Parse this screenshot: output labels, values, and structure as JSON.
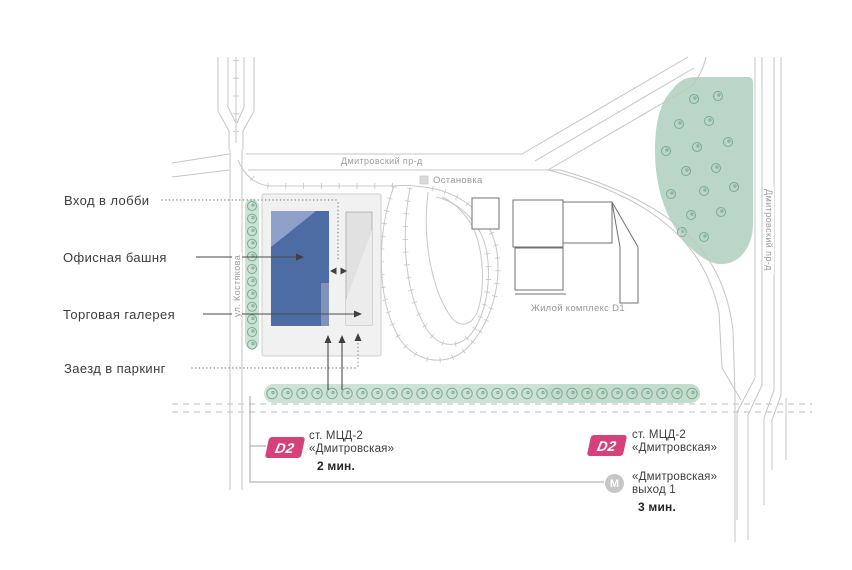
{
  "colors": {
    "d2_badge": "#d6417b",
    "metro_badge": "#c6c6c6",
    "office_tower": "#4e6ca4",
    "office_tower_light": "#8ea1c8",
    "gallery": "#e1e1e1",
    "plot": "#f1f1f1",
    "park": "#b9d6c6",
    "tree_band": "#cde2d6",
    "tree_stroke": "#79ab90",
    "road": "#c5c5c5"
  },
  "legend": {
    "lobby_entrance": "Вход в лобби",
    "office_tower": "Офисная башня",
    "retail_gallery": "Торговая галерея",
    "parking_entrance": "Заезд в паркинг"
  },
  "streets": {
    "dmitrovsky_top": "Дмитровский пр-д",
    "kostyakova": "ул. Костякова",
    "dmitrovsky_right": "Дмитровский пр-д"
  },
  "landmarks": {
    "bus_stop": "Остановка",
    "residential_complex": "Жилой комплекс D1"
  },
  "transit": {
    "mcd_left": {
      "badge": "D2",
      "station_line1": "ст. МЦД-2",
      "station_line2": "«Дмитровская»",
      "walk_time": "2 мин."
    },
    "mcd_right": {
      "badge": "D2",
      "station_line1": "ст. МЦД-2",
      "station_line2": "«Дмитровская»"
    },
    "metro_exit": {
      "badge": "M",
      "line1": "«Дмитровская»",
      "line2": "выход 1",
      "walk_time": "3 мин."
    }
  }
}
